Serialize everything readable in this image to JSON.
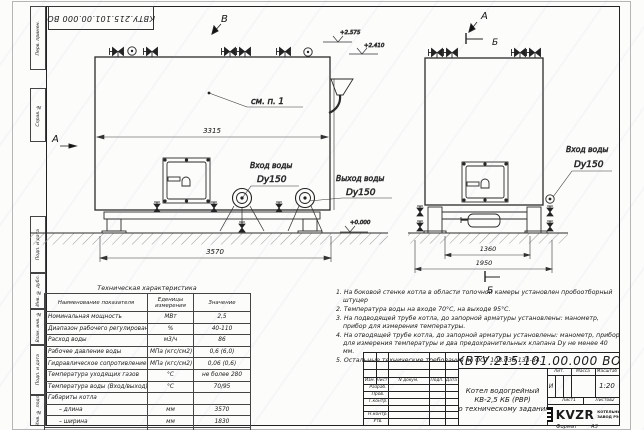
{
  "frame": {
    "stamp_top": "КВТУ.215.101.00.000 ВО",
    "side_labels": [
      "Перв. примен.",
      "Справ. №",
      "Подп. и дата",
      "Инв. № дубл.",
      "Взам. инв. №",
      "Подп. и дата",
      "Инв. № подл."
    ],
    "format_label": "Формат",
    "format_value": "А3"
  },
  "drawing": {
    "views": {
      "v_label": "В",
      "a_arrow_label": "А",
      "a_view_label": "А",
      "b_section_top": "Б",
      "b_section_bottom": "Б"
    },
    "callout_see_note": "см. п. 1",
    "water_inlet_left": {
      "l1": "Вход воды",
      "l2": "Dy150"
    },
    "water_outlet": {
      "l1": "Выход воды",
      "l2": "Dy150"
    },
    "water_inlet_right": {
      "l1": "Вход воды",
      "l2": "Dy150"
    },
    "elevations": {
      "e1": "+2.575",
      "e2": "+2.410",
      "e3": "+0.000"
    },
    "dims": {
      "d3315": "3315",
      "d3570": "3570",
      "d1360": "1360",
      "d1950": "1950"
    }
  },
  "tech_table": {
    "title": "Техническая характеристика",
    "headers": [
      "Наименование показателя",
      "Еденицы измерения",
      "Значение"
    ],
    "rows": [
      [
        "Номинальная мощность",
        "МВт",
        "2,5"
      ],
      [
        "Диапазон рабочего регулирования",
        "%",
        "40-110"
      ],
      [
        "Расход воды",
        "м3/ч",
        "86"
      ],
      [
        "Рабочее давление воды",
        "МПа (кгс/см2)",
        "0,6 (6,0)"
      ],
      [
        "Гидравлическое сопротивление котла",
        "МПа (кгс/см2)",
        "0,06 (0,6)"
      ],
      [
        "Температура уходящих газов",
        "°С",
        "не более 280"
      ],
      [
        "Температура воды (Вход/выход)",
        "°С",
        "70/95"
      ],
      [
        "Габариты котла",
        "",
        ""
      ],
      [
        "– длина",
        "мм",
        "3570"
      ],
      [
        "– ширина",
        "мм",
        "1830"
      ],
      [
        "– высота",
        "мм",
        "2460"
      ]
    ]
  },
  "notes": [
    "1.  На боковой стенке котла в области топочной камеры установлен пробоотборный штуцер",
    "2.  Температура воды на входе 70°С, на выходе 95°С.",
    "3.  На подводящей трубе котла, до запорной арматуры установлены: манометр, прибор для измерения температуры.",
    "4.  На отводящей трубе котла, до запорной арматуры установлены: манометр, прибор для измерения температуры и два предохранительных клапана Dу не менее 40 мм.",
    "5.  Остальные технические требования по ОСТ 108.030.133-84."
  ],
  "title_block": {
    "designation": "КВТУ.215.101.00.000 ВО",
    "rev_headers": [
      "Изм.",
      "Лист",
      "N докум.",
      "Подп.",
      "Дата"
    ],
    "roles": [
      "Разраб.",
      "Пров.",
      "Т.контр.",
      "Н.контр.",
      "Утв."
    ],
    "title_line1": "Котел водогрейный",
    "title_line2": "КВ-2,5 КБ (РВР)",
    "title_line3": "по техническому заданию",
    "lit_header": "Лит.",
    "mass_header": "Масса",
    "scale_header": "Масштаб",
    "lit_value": "И",
    "scale_value": "1:20",
    "sheet_label": "Лист",
    "sheet_value": "1",
    "sheets_label": "Листов",
    "sheets_value": "2",
    "logo_text": "KVZR",
    "logo_sub1": "КОТЕЛЬНЫЙ",
    "logo_sub2": "ЗАВОД РЭП"
  }
}
